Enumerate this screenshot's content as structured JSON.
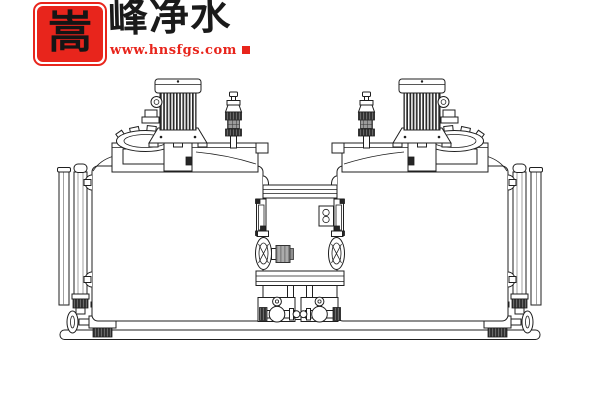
{
  "page": {
    "background": "#ffffff",
    "width": 600,
    "height": 400
  },
  "logo": {
    "seal_character": "嵩",
    "brand_text": "峰净水",
    "website": "www.hnsfgs.com",
    "seal_color": "#e8251c",
    "brand_text_color": "#1a1a1a",
    "website_color": "#e8251c",
    "red_square_icon": "red-square"
  },
  "drawing": {
    "type": "engineering-line-drawing",
    "subject": "dual-tank chemical dosing mixing skid, front elevation",
    "line_color": "#1f1f1f",
    "background_color": "#ffffff",
    "motor_fin_color": "#2a2a2a",
    "pump_motor_color": "#a8a8a8",
    "components": {
      "left_unit": [
        "agitator-motor",
        "motor-cap",
        "motor-junction-knob",
        "motor-mounting-flange",
        "manhole-cover",
        "feed-valve-fitting",
        "tank-crown",
        "tank-body",
        "level-gauge",
        "standpipe",
        "drain-valve-with-handwheel"
      ],
      "right_unit": [
        "agitator-motor",
        "motor-cap",
        "motor-junction-knob",
        "motor-mounting-flange",
        "manhole-cover",
        "feed-valve-fitting",
        "tank-crown",
        "tank-body",
        "level-gauge",
        "standpipe",
        "drain-valve-with-handwheel"
      ],
      "center_section": [
        "connecting-bridge",
        "wall-pipe-stubs",
        "mounting-bracket-left",
        "mounting-bracket-right",
        "junction-box",
        "dosing-pump-left",
        "pump-motor",
        "dosing-pump-right",
        "platform",
        "support-legs",
        "ball-valve-left",
        "ball-valve-right"
      ],
      "base": [
        "skid-rail-upper",
        "skid-rail-lower"
      ]
    }
  }
}
